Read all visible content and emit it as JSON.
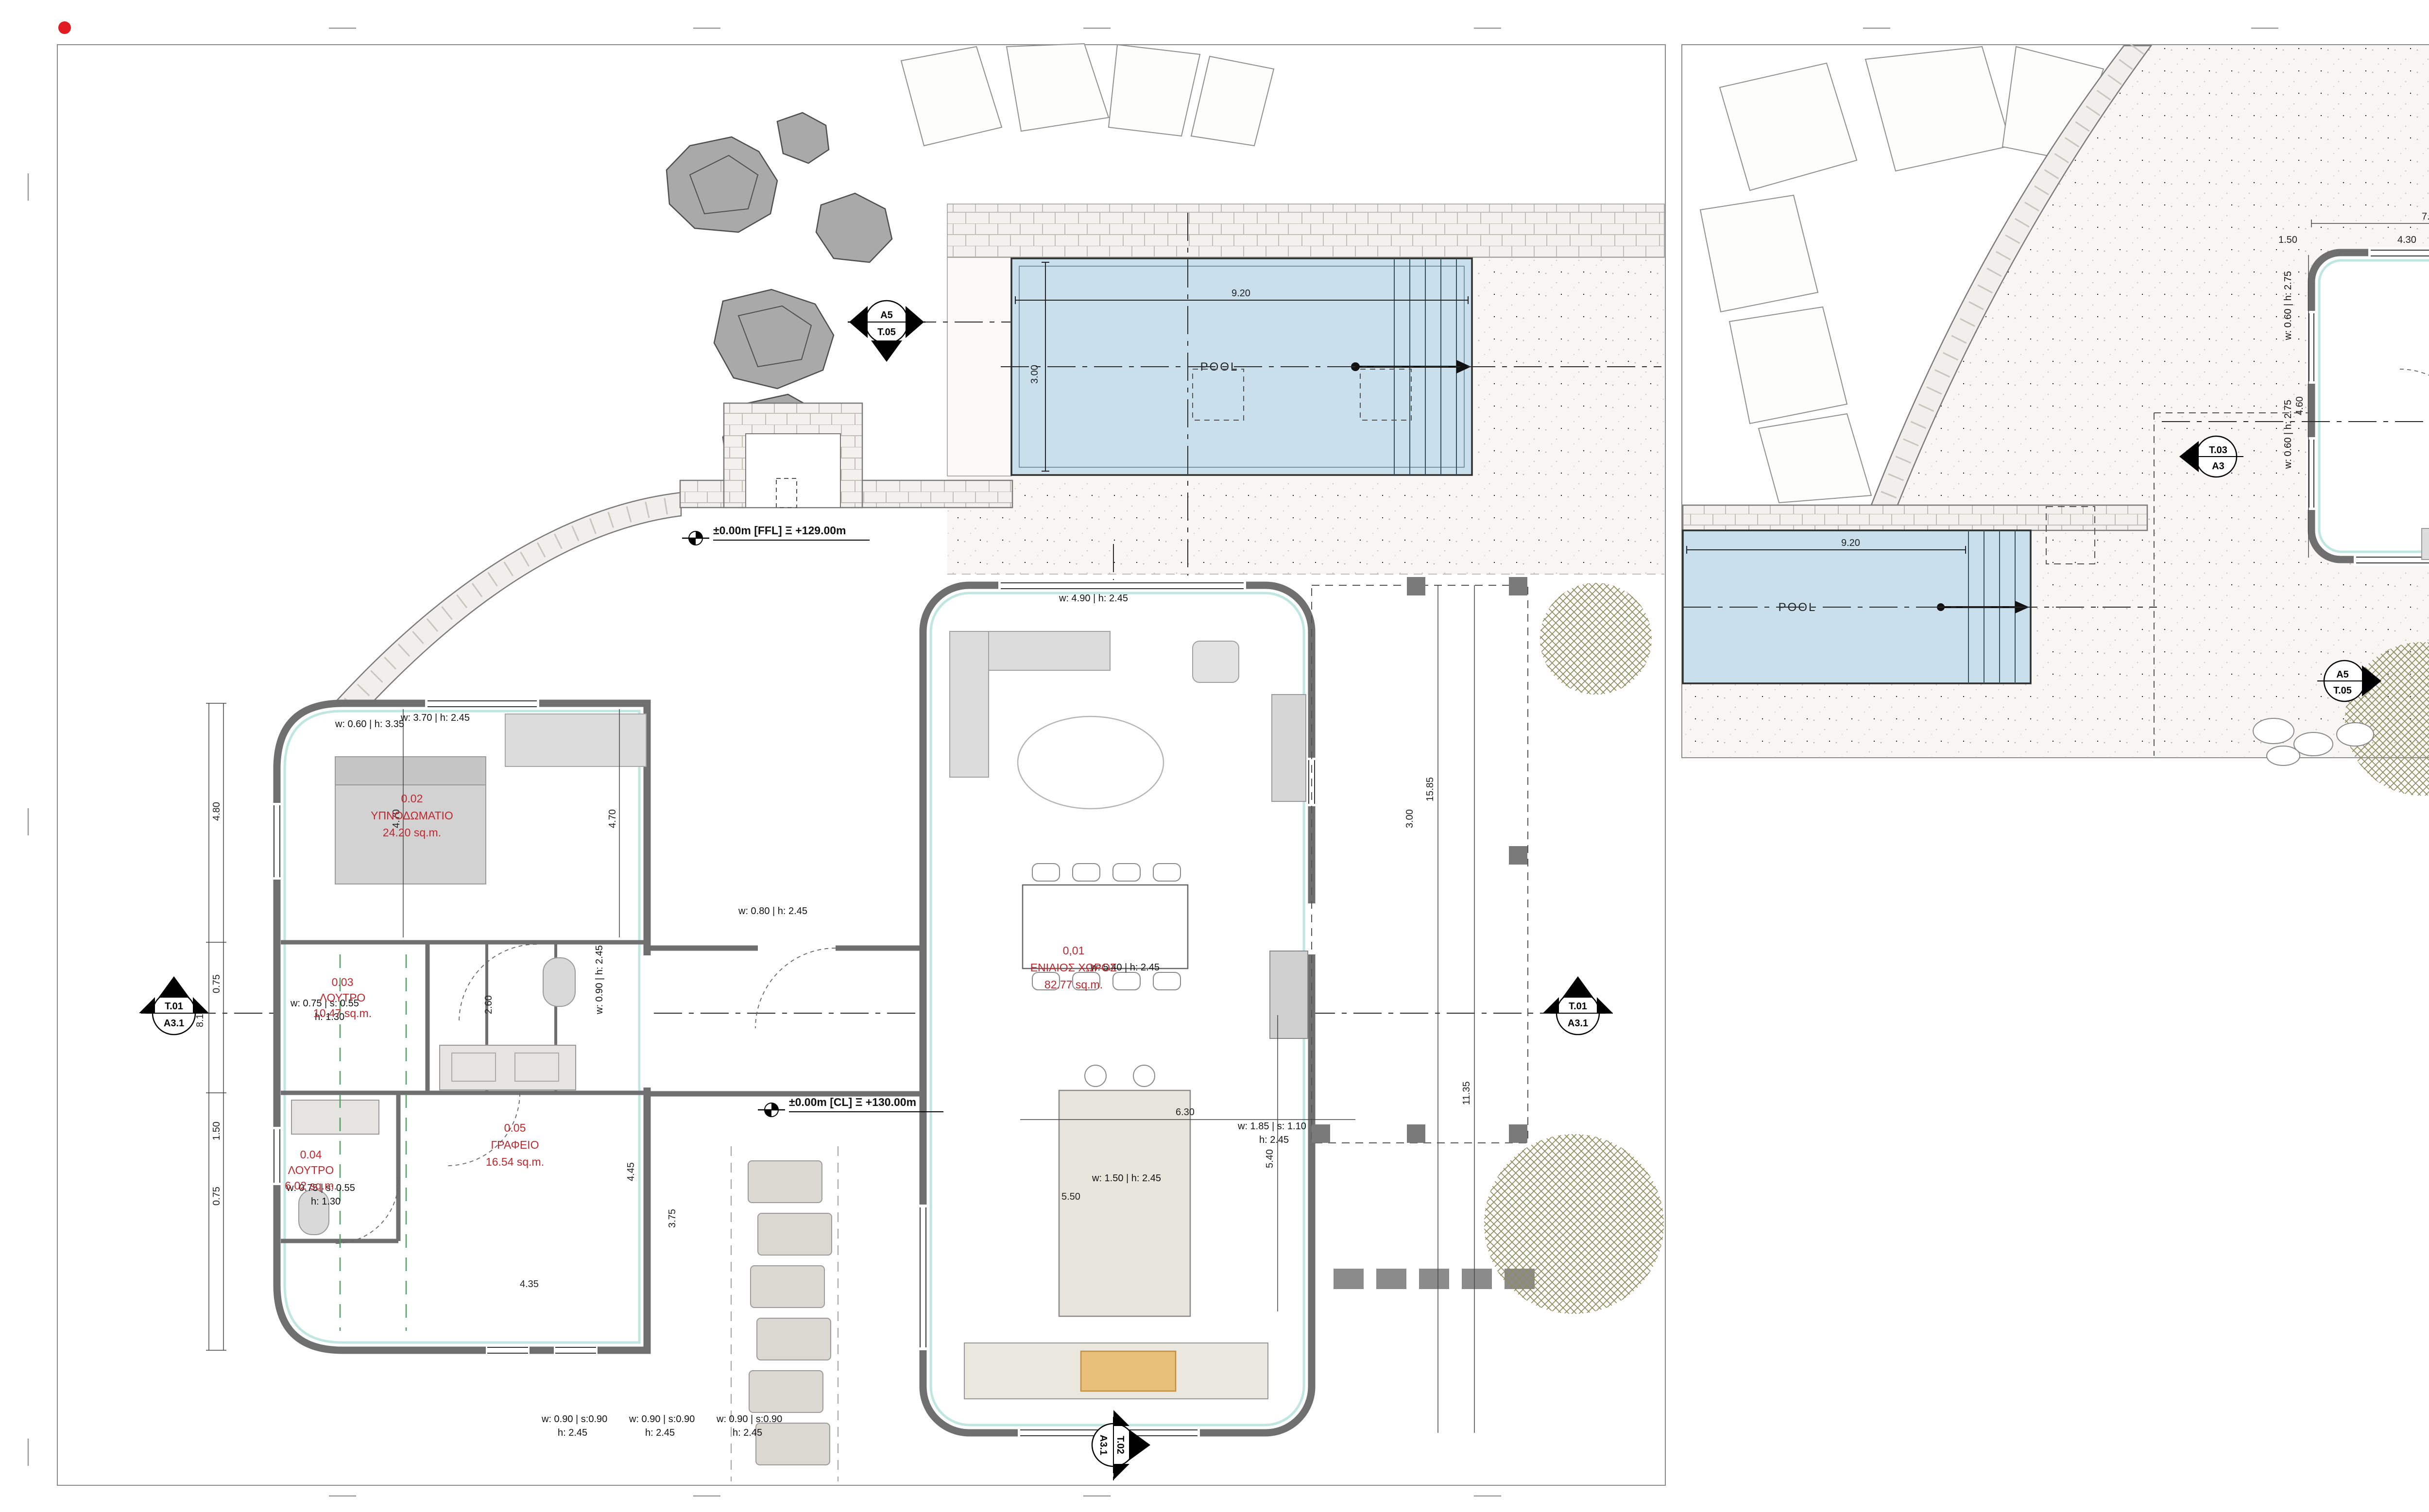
{
  "colors": {
    "accent_red": "#e01b22",
    "room_label_red": "#c0272d",
    "pool_blue": "#c9dfec",
    "wall_gray": "#6f6f6f",
    "cyan_lining": "#bfe6e0",
    "tree_olive": "#8b8c5c",
    "logo_orange": "#d98e2b",
    "logo_gray": "#6d6e71",
    "logo_steel": "#8ba1ad"
  },
  "sheet1": {
    "pool": {
      "label": "POOL",
      "dim_w": "9.20",
      "dim_d": "3.00"
    },
    "rooms": [
      {
        "code": "0,01",
        "name": "ΕΝΙΑΙΟΣ ΧΩΡΟΣ",
        "area": "82.77 sq.m."
      },
      {
        "code": "0.02",
        "name": "ΥΠΝΟΔΩΜΑΤΙΟ",
        "area": "24.20 sq.m."
      },
      {
        "code": "0.03",
        "name": "ΛΟΥΤΡΟ",
        "area": "10.47 sq.m."
      },
      {
        "code": "0.04",
        "name": "ΛΟΥΤΡΟ",
        "area": "6.02 sq.m."
      },
      {
        "code": "0.05",
        "name": "ΓΡΑΦΕΙΟ",
        "area": "16.54 sq.m."
      }
    ],
    "levels": [
      "±0.00m [FFL] Ξ +129.00m",
      "±0.00m [CL] Ξ +130.00m"
    ],
    "markers": [
      {
        "top": "A5",
        "bottom": "T.05"
      },
      {
        "top": "T.01",
        "bottom": "A3.1"
      },
      {
        "top": "T.01",
        "bottom": "A3.1"
      },
      {
        "top": "T.02",
        "bottom": "A3.1"
      }
    ],
    "windows": [
      {
        "a": "w: 0.60 | h: 3.35",
        "b": ""
      },
      {
        "a": "w: 0.75 | s: 0.55",
        "b": "h: 1.30"
      },
      {
        "a": "w: 0.75 | s: 0.55",
        "b": "h: 1.30"
      },
      {
        "a": "w: 0.90 | h: 2.45",
        "b": ""
      },
      {
        "a": "w: 0.80 | h: 2.45",
        "b": ""
      },
      {
        "a": "w: 0.90 | s:0.90",
        "b": "h: 2.45"
      },
      {
        "a": "w: 0.90 | s:0.90",
        "b": "h: 2.45"
      },
      {
        "a": "w: 0.90 | s:0.90",
        "b": "h: 2.45"
      },
      {
        "a": "w: 5.40 | h: 2.45",
        "b": ""
      },
      {
        "a": "w: 1.50 | h: 2.45",
        "b": ""
      },
      {
        "a": "w: 1.85 | s: 1.10",
        "b": "h: 2.45"
      },
      {
        "a": "w: 3.70 | h: 2.45",
        "b": ""
      },
      {
        "a": "w: 4.90 | h: 2.45",
        "b": ""
      }
    ],
    "dims": [
      "9.20",
      "3.00",
      "8.15",
      "4.80",
      "0.75",
      "1.50",
      "0.75",
      "4.70",
      "4.70",
      "2.60",
      "15.85",
      "11.35",
      "5.40",
      "6.30",
      "5.50",
      "4.45",
      "3.75",
      "4.35",
      "3.00"
    ]
  },
  "sheet2": {
    "pool": {
      "label": "POOL",
      "dim_w": "9.20"
    },
    "rooms": [
      {
        "code": "1.01",
        "name": "ΥΠΝΟΔΩΜΑΤΙΟ",
        "area": "28.95 sq.m."
      },
      {
        "code": "1.02",
        "name": "ΛΟΥΤΡΟ",
        "area": "8.28 sq.m."
      }
    ],
    "markers": [
      {
        "top": "T.04",
        "bottom": "A3"
      },
      {
        "top": "T.03",
        "bottom": "A34"
      },
      {
        "top": "T.03",
        "bottom": "A3"
      },
      {
        "top": "A5",
        "bottom": "T.05"
      },
      {
        "top": "T.04",
        "bottom": "A3"
      }
    ],
    "windows": [
      {
        "a": "w: 0.60 | h: 2.75"
      },
      {
        "a": "w: 0.60 | h: 2.75"
      }
    ],
    "dims": [
      "9.20",
      "7.55",
      "4.30",
      "1.50",
      "1.90",
      "1.10",
      "0.65",
      "4.60",
      "6.75",
      "5.95",
      "2.40",
      "3.45",
      "5.80",
      "2.25",
      "1.95",
      "1.35",
      "2.35",
      "0.80"
    ]
  },
  "titleblock": {
    "header_left": "ΕΜΜΑΝΟΥΗΛ  Γ. ΠΕΠΟΝΗΣ",
    "header_right": "ΑΡΧΙΤΕΚΤΩΝ ΜΗΧΑΝΙΚΟΣ IUAV",
    "office_left": "ΑΡΧΙΤΕΚΤΟΝΙΚΟ ΓΡΑΦΕΙΟ",
    "office_right_l1": "ΑΡΧΙΤΕΚΤΟΝΙΚΟΣ  ΣΧΕΔΙΑΣΜΟΣ",
    "office_right_l2": "ΕΠΙΒΛΕΨΗ",
    "ergo_label": "ΕΡΓΟ",
    "ergo_l1": "ΝΕΑ ΙΣΟΓΕΙΑ ΚΑΤΟΙΚΙΑ ΜΕ ΙΣΟΓΕΙΟ ΞΕΝΩΝΑ ΚΑΙ",
    "ergo_l2": "ΚΟΛΥΜΒΗΤΙΚΗ ΔΕΞΑΜΕΝΗ",
    "thesi_label": "ΘΕΣΗ",
    "thesi_l1": "ΜΑΡΔΑΤΙ\"  ΔΗΜΟΤΙΚΗΣ ΚΟΙΝΟΤΗΤΑΣ ΚΡΙΤΣΑΣ,",
    "thesi_l2": "ΔΗΜΟΥ ΑΓΙΟΥ ΝΙΚΟΛΑΟΥ",
    "kyrios_label": "ΚΥΡΙΟΣ",
    "kyrios_l1": "JACQUELINE O'  CONNELL",
    "kyrios_l2": "[ΤΖΑΚΛΙΝ Ο΄ ΚΟΝΕΛ]",
    "sxedio_label": "ΣΧΕΔΙΟ",
    "drawing_code_letter": "A",
    "drawing_code_number": "01",
    "drawing_title": "ΚΑΤΟΨΕΙΣ",
    "date": "ΦΕΒΡΟΥΑΡΙΟΣ 2025",
    "stamp_label": "ΣΦΡΑΓΙΔΑ & ΥΠΟΓΡΑΦΗ ΜΕΛΕΤΗΤΗ:",
    "kod_label": "ΚΩΔ",
    "address_l1": "Καπετάν Ταβλά 12, Άγιος Νικόλαος, 72100, Κρήτη",
    "address_l2": "Τ.: 28410 28804 • email: info.cretehomes@gmail.com",
    "address_l3": "www.crete-homes.com • www.peponis.gr",
    "crete_homes": {
      "l1": "CRETE",
      "l2": "HOMES",
      "l3": "REAL ESTATE",
      "l4": "CRETE PROPERTY",
      "l5": "and",
      "l6": "CONSTRUCTION",
      "l7": "CONSULTANTS",
      "l8": "SINCE 1990",
      "reg": "®"
    },
    "peponis": {
      "name": "E.PEPONIS",
      "plus": "PLUS",
      "arch": "architects",
      "tagline": "ARCHITECT  LED  DESIGN  -  BUILD"
    }
  }
}
